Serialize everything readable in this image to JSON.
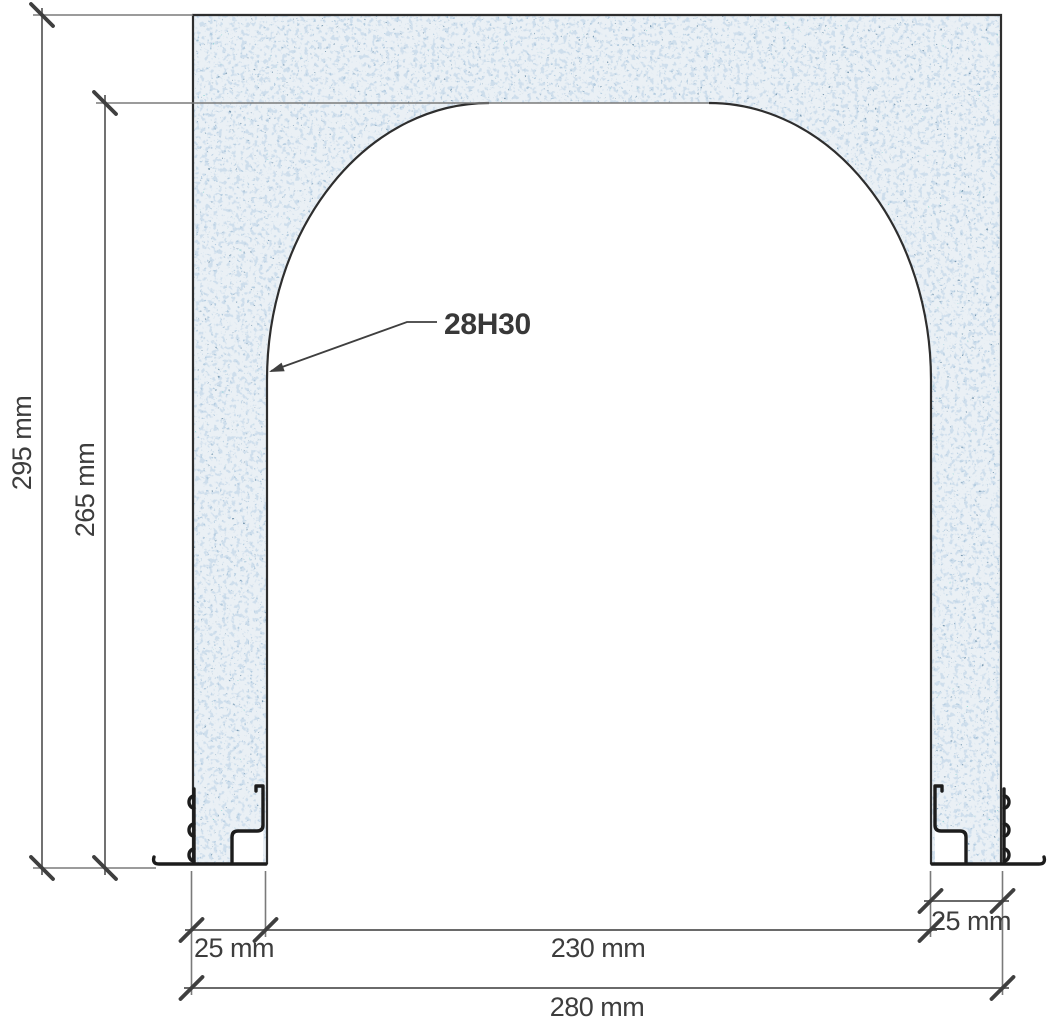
{
  "drawing": {
    "kind": "cross-section-technical-drawing",
    "labels": {
      "overall_height": "295 mm",
      "opening_height": "265 mm",
      "left_wall": "25 mm",
      "opening_width": "230 mm",
      "overall_width": "280 mm",
      "right_wall": "25 mm",
      "component": "28H30"
    },
    "colors": {
      "material_base": "#eaf0f5",
      "speck_light": "#9ebad6",
      "speck_mid": "#739abd",
      "speck_dark": "#335473",
      "speck_teal": "#29a097",
      "outline": "#2e2e2e",
      "foot_profile": "#1c1c1c",
      "dimension_line": "#6a6a6a",
      "dimension_text": "#3d3d3d"
    }
  }
}
